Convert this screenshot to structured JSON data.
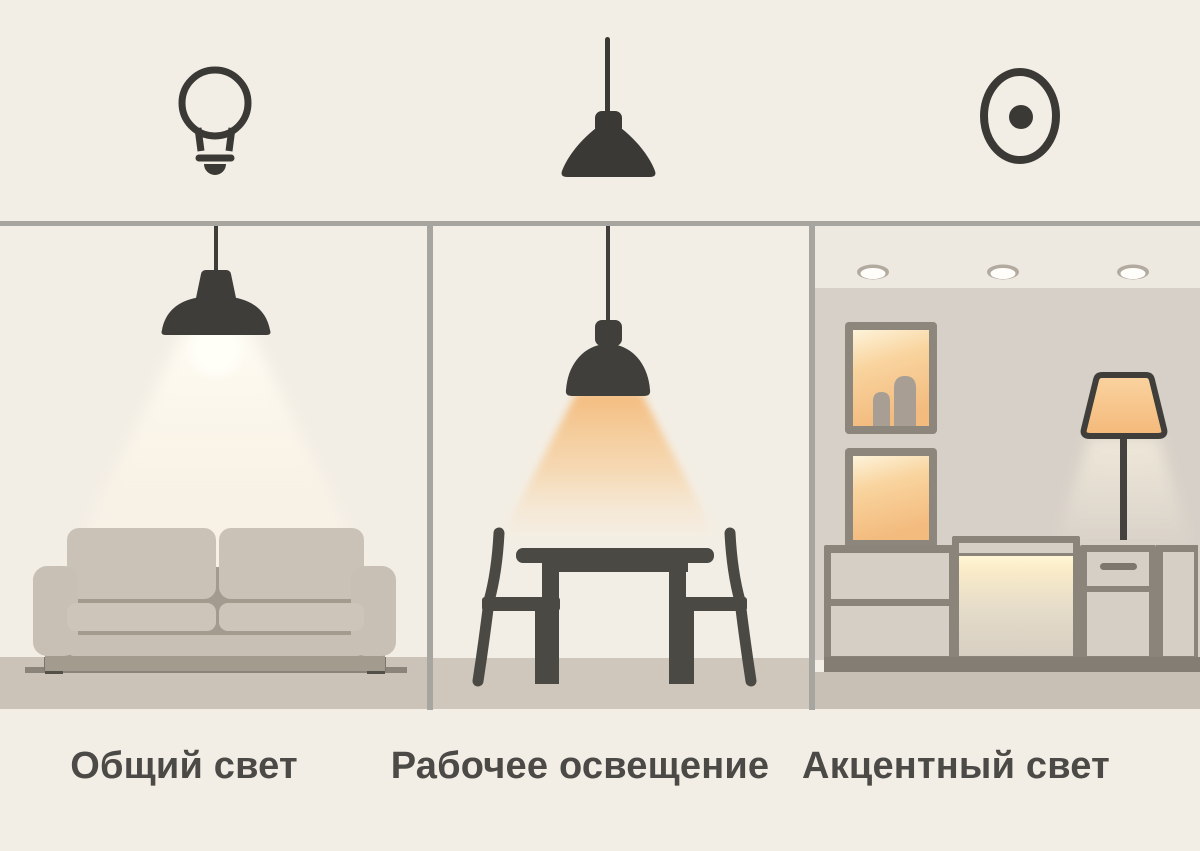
{
  "panels": [
    {
      "id": "general",
      "icon": "bulb-icon",
      "label": "Общий свет",
      "scene": "sofa-under-pendant-light"
    },
    {
      "id": "task",
      "icon": "pendant-lamp-icon",
      "label": "Рабочее освещение",
      "scene": "dining-table-under-pendant-light"
    },
    {
      "id": "accent",
      "icon": "spotlight-icon",
      "label": "Акцентный свет",
      "scene": "niches-floor-lamp-accent-lighting"
    }
  ],
  "palette": {
    "background": "#f3eee5",
    "divider_gray": "#a7a5a0",
    "silhouette_dark": "#3a3935",
    "furniture_gray": "#4a4944",
    "sofa_body": "#c9c0b5",
    "sofa_shadow": "#a49b8f",
    "floor_taupe": "#cbc3b8",
    "accent_wall": "#d7d0c8",
    "accent_ceiling": "#ede8e0",
    "cabinet_frame": "#8a847b",
    "cabinet_front": "#d6cfc6",
    "warm_light": "#f5bf82",
    "warm_light_pale": "#fdf0d4",
    "label_text": "#4b4a47"
  }
}
